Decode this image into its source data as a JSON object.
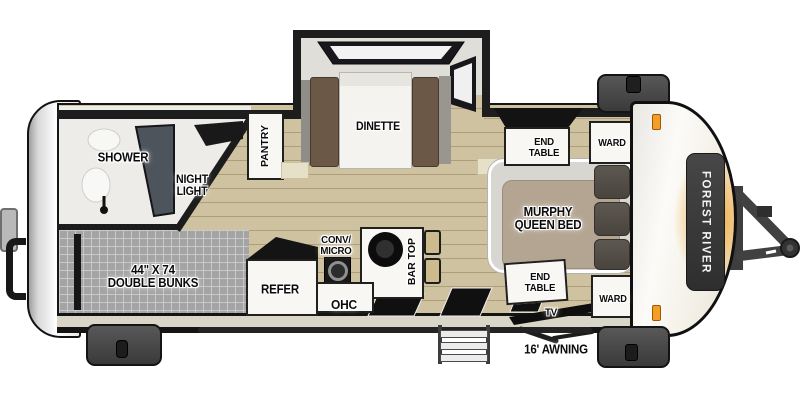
{
  "plan": {
    "brand_badge": "FOREST RIVER",
    "labels": {
      "shower": "SHOWER",
      "night_light": "NIGHT\nLIGHT",
      "pantry": "PANTRY",
      "dinette": "DINETTE",
      "double_bunks": "44\" X 74\nDOUBLE BUNKS",
      "refer": "REFER",
      "conv_micro": "CONV/\nMICRO",
      "ohc": "OHC",
      "bar_top": "BAR TOP",
      "murphy_bed": "MURPHY\nQUEEN BED",
      "end_table_top": "END\nTABLE",
      "end_table_bottom": "END\nTABLE",
      "ward_top": "WARD",
      "ward_bottom": "WARD",
      "tv": "TV",
      "awning": "16' AWNING"
    },
    "colors": {
      "wall": "#1D1D1D",
      "floor_tan": "#CFC2A0",
      "bunk_gray": "#A4A4A4",
      "accent_orange": "#F2A42B",
      "cap_white": "#F7F5F0",
      "label_text": "#0B0B0B"
    }
  }
}
